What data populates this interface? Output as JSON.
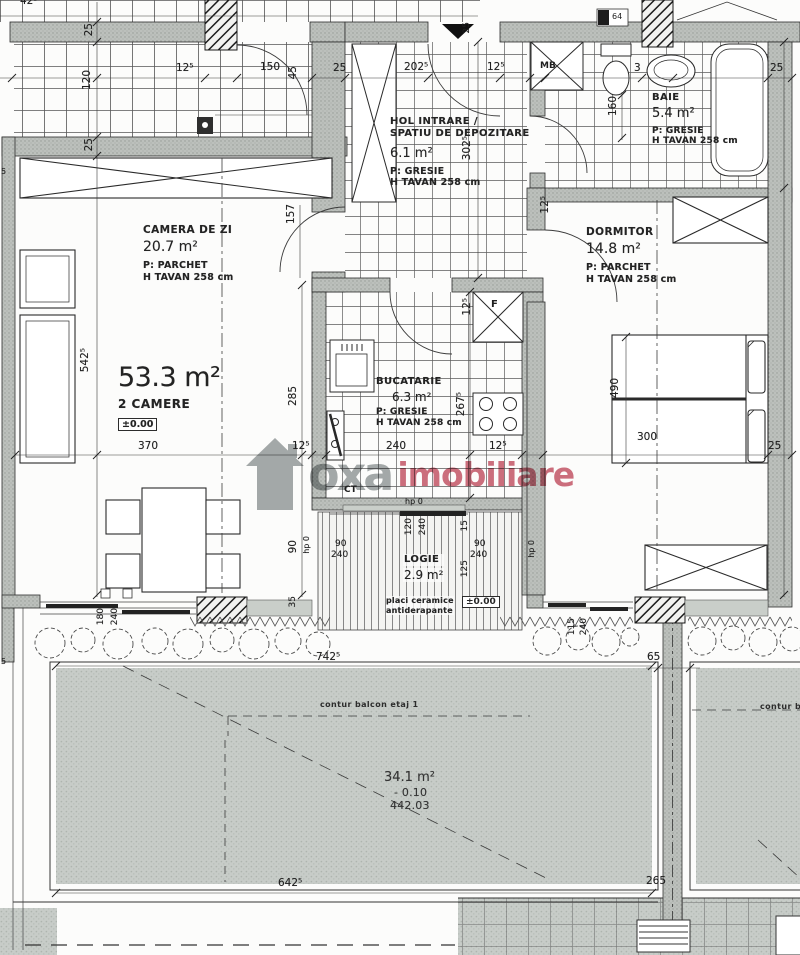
{
  "watermark": {
    "brand_gray": "oxa",
    "brand_red": "imobiliare",
    "gray_hex": "#8f9596",
    "red_hex": "#c24b5e"
  },
  "apartment": {
    "total_area": "53.3 m²",
    "rooms_label": "2 CAMERE",
    "level": "±0.00"
  },
  "rooms": {
    "camera_zi": {
      "name": "CAMERA DE ZI",
      "area": "20.7 m²",
      "floor": "P: PARCHET",
      "ceiling": "H TAVAN 258 cm"
    },
    "hol": {
      "name_line1": "HOL INTRARE /",
      "name_line2": "SPATIU DE DEPOZITARE",
      "area": "6.1 m²",
      "floor": "P: GRESIE",
      "ceiling": "H TAVAN 258 cm"
    },
    "baie": {
      "name": "BAIE",
      "area": "5.4 m²",
      "floor": "P: GRESIE",
      "ceiling": "H TAVAN 258 cm"
    },
    "dormitor": {
      "name": "DORMITOR",
      "area": "14.8 m²",
      "floor": "P: PARCHET",
      "ceiling": "H TAVAN 258 cm"
    },
    "bucatarie": {
      "name": "BUCATARIE",
      "area": "6.3 m²",
      "floor": "P: GRESIE",
      "ceiling": "H TAVAN 258 cm"
    },
    "logie": {
      "name": "LOGIE",
      "area": "2.9 m²",
      "floor_line1": "placi ceramice",
      "floor_line2": "antiderapante",
      "level": "±0.00"
    },
    "terasa": {
      "area": "34.1 m²",
      "level": "- 0.10",
      "elevation": "442.03",
      "contour_label": "contur balcon etaj 1"
    }
  },
  "markers": {
    "washing_machine": "MB",
    "fridge": "F",
    "boiler": "CT",
    "top_box": "64"
  },
  "dimensions": [
    {
      "t": "42⁵",
      "x": 20,
      "y": -4
    },
    {
      "t": "25",
      "x": 84,
      "y": 23,
      "r": 1
    },
    {
      "t": "120",
      "x": 82,
      "y": 70,
      "r": 1
    },
    {
      "t": "12⁵",
      "x": 176,
      "y": 63
    },
    {
      "t": "150",
      "x": 260,
      "y": 62
    },
    {
      "t": "45",
      "x": 288,
      "y": 66,
      "r": 1
    },
    {
      "t": "25",
      "x": 333,
      "y": 63
    },
    {
      "t": "202⁵",
      "x": 404,
      "y": 62
    },
    {
      "t": "12⁵",
      "x": 487,
      "y": 62
    },
    {
      "t": "25",
      "x": 463,
      "y": 22,
      "r": 1,
      "fs": 9
    },
    {
      "t": "3",
      "x": 634,
      "y": 63
    },
    {
      "t": "25",
      "x": 770,
      "y": 63
    },
    {
      "t": "25",
      "x": 84,
      "y": 138,
      "r": 1
    },
    {
      "t": "160",
      "x": 608,
      "y": 96,
      "r": 1
    },
    {
      "t": "302⁵",
      "x": 462,
      "y": 136,
      "r": 1
    },
    {
      "t": "157",
      "x": 286,
      "y": 204,
      "r": 1
    },
    {
      "t": "12⁵",
      "x": 540,
      "y": 196,
      "r": 1
    },
    {
      "t": "542⁵",
      "x": 80,
      "y": 348,
      "r": 1
    },
    {
      "t": "285",
      "x": 288,
      "y": 386,
      "r": 1
    },
    {
      "t": "12⁵",
      "x": 462,
      "y": 298,
      "r": 1
    },
    {
      "t": "267⁵",
      "x": 456,
      "y": 392,
      "r": 1
    },
    {
      "t": "370",
      "x": 138,
      "y": 441
    },
    {
      "t": "12⁵",
      "x": 292,
      "y": 441
    },
    {
      "t": "240",
      "x": 386,
      "y": 441
    },
    {
      "t": "12⁵",
      "x": 489,
      "y": 441
    },
    {
      "t": "300",
      "x": 637,
      "y": 432
    },
    {
      "t": "25",
      "x": 768,
      "y": 441
    },
    {
      "t": "490",
      "x": 610,
      "y": 378,
      "r": 1
    },
    {
      "t": "90",
      "x": 288,
      "y": 540,
      "r": 1
    },
    {
      "t": "hp 0",
      "x": 303,
      "y": 536,
      "r": 1,
      "fs": 8
    },
    {
      "t": "90",
      "x": 335,
      "y": 540,
      "fs": 9
    },
    {
      "t": "240",
      "x": 331,
      "y": 551,
      "fs": 9
    },
    {
      "t": "hp 0",
      "x": 405,
      "y": 498,
      "fs": 8
    },
    {
      "t": "120",
      "x": 405,
      "y": 518,
      "r": 1,
      "fs": 9
    },
    {
      "t": "240",
      "x": 419,
      "y": 518,
      "r": 1,
      "fs": 9
    },
    {
      "t": "15",
      "x": 461,
      "y": 520,
      "r": 1,
      "fs": 9
    },
    {
      "t": "90",
      "x": 474,
      "y": 540,
      "fs": 9
    },
    {
      "t": "240",
      "x": 470,
      "y": 551,
      "fs": 9
    },
    {
      "t": "125",
      "x": 461,
      "y": 560,
      "r": 1,
      "fs": 9
    },
    {
      "t": "hp 0",
      "x": 528,
      "y": 540,
      "r": 1,
      "fs": 8
    },
    {
      "t": "180",
      "x": 97,
      "y": 608,
      "r": 1,
      "fs": 9
    },
    {
      "t": "240",
      "x": 111,
      "y": 608,
      "r": 1,
      "fs": 9
    },
    {
      "t": "35",
      "x": 289,
      "y": 596,
      "r": 1,
      "fs": 9
    },
    {
      "t": "115",
      "x": 568,
      "y": 618,
      "r": 1,
      "fs": 9
    },
    {
      "t": "240",
      "x": 580,
      "y": 618,
      "r": 1,
      "fs": 9
    },
    {
      "t": "65",
      "x": 647,
      "y": 652
    },
    {
      "t": "742⁵",
      "x": 316,
      "y": 652
    },
    {
      "t": "642⁵",
      "x": 278,
      "y": 878
    },
    {
      "t": "265",
      "x": 646,
      "y": 876
    },
    {
      "t": "5",
      "x": 1,
      "y": 168,
      "fs": 8
    },
    {
      "t": "5",
      "x": 1,
      "y": 658,
      "fs": 8
    }
  ]
}
